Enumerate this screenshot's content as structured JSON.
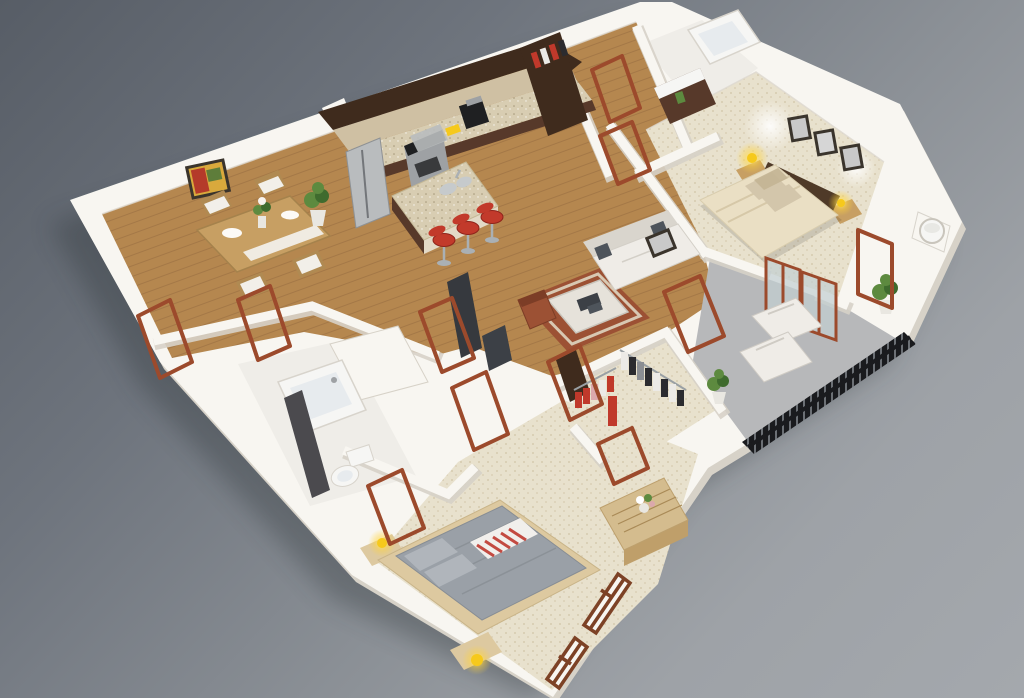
{
  "scene": {
    "type": "isometric-3d-apartment-floor-plan-render",
    "rooms": [
      {
        "name": "kitchen",
        "floor": "wood",
        "items": [
          "upper-cabinets",
          "lower-cabinets",
          "backsplash",
          "refrigerator",
          "range-oven",
          "range-hood",
          "coffee-maker",
          "kitchen-island",
          "island-sink",
          "bar-stools"
        ]
      },
      {
        "name": "dining-area",
        "floor": "wood",
        "items": [
          "dining-table",
          "table-runner",
          "plates",
          "flower-vase",
          "dining-chairs",
          "wall-art",
          "potted-plant"
        ]
      },
      {
        "name": "living-room",
        "floor": "wood",
        "items": [
          "sofa",
          "throw-pillows",
          "wall-picture",
          "area-rug",
          "coffee-table",
          "armchair",
          "tv-panel",
          "media-console"
        ]
      },
      {
        "name": "master-bedroom",
        "floor": "carpet",
        "items": [
          "double-bed",
          "headboard",
          "pillows",
          "nightstand",
          "table-lamp",
          "picture-frames",
          "balcony-doors"
        ]
      },
      {
        "name": "balcony",
        "floor": "concrete",
        "items": [
          "lounge-chairs",
          "potted-plant",
          "railing"
        ]
      },
      {
        "name": "walk-in-closet",
        "floor": "carpet",
        "items": [
          "clothes-rack",
          "hanging-clothes",
          "shelf-unit"
        ]
      },
      {
        "name": "guest-bedroom",
        "floor": "carpet",
        "items": [
          "bed",
          "gray-duvet",
          "striped-throw",
          "nightstands",
          "table-lamps",
          "dresser",
          "flower-vase",
          "windows",
          "door"
        ]
      },
      {
        "name": "bathroom",
        "floor": "tile",
        "items": [
          "bathtub",
          "toilet",
          "shower-partition",
          "laundry-closet"
        ]
      },
      {
        "name": "entry-hall",
        "floor": "wood",
        "items": [
          "entry-closet",
          "hanging-clothes",
          "doors"
        ]
      },
      {
        "name": "second-bathroom",
        "floor": "tile",
        "items": [
          "bathtub",
          "vanity",
          "towel"
        ]
      },
      {
        "name": "utility-closet",
        "floor": "wood",
        "items": [
          "water-heater"
        ]
      }
    ]
  },
  "palette": {
    "shadow": "#2c3036",
    "wall_top": "#f8f6f1",
    "wall_face": "#e9e4db",
    "wall_edge": "#d7d2c8",
    "wall_inner": "#ddd8cf",
    "wood": "#b5874f",
    "wood_line": "#9c7242",
    "carpet": "#e8e1cd",
    "carpet_dot": "#cbbc9c",
    "balcony_floor": "#b7b8ba",
    "tile": "#efede8",
    "cabinet_dark": "#3f2b1d",
    "cabinet_mid": "#57392a",
    "granite": "#d8cdb2",
    "granite_dot": "#8d815f",
    "backsplash": "#cfc0a3",
    "stainless": "#b9bcbe",
    "stainless_dark": "#9ea1a4",
    "appliance_black": "#1f2022",
    "island_base": "#e3d9c6",
    "stool_red": "#c23a2b",
    "stool_red_dark": "#8f241b",
    "metal": "#aab0b4",
    "dining_wood": "#c79f63",
    "chair_wood": "#b08a52",
    "cushion_white": "#f2efe9",
    "art_red": "#b43a2a",
    "art_green": "#5e7d3a",
    "art_gold": "#d9a93c",
    "frame_dark": "#3a342c",
    "plant": "#5d8a3f",
    "plant_dark": "#3f6b2e",
    "pot": "#e9e7e1",
    "sofa": "#efece7",
    "sofa_shadow": "#d9d5cd",
    "pillow_dark": "#4e545b",
    "rug": "#9c5134",
    "rug_light": "#d8c8b2",
    "table_light": "#e6e2da",
    "book_dark": "#3c4046",
    "tv_dark": "#36393e",
    "bed_cream": "#eadfc4",
    "bed_cream_shadow": "#d6c8a8",
    "pillow_beige": "#d3c6ab",
    "headboard": "#4f3a28",
    "lamp_yellow": "#f6c91c",
    "rail_dark": "#1a1b1e",
    "rail_gap": "#75797f",
    "closet_red": "#c0392b",
    "closet_white": "#eceae6",
    "closet_black": "#2b2b2f",
    "closet_pink": "#dba8ac",
    "closet_gray": "#8b8e93",
    "rod": "#9aa0a4",
    "dresser": "#d4bc8e",
    "dresser_face": "#bf9f6a",
    "bed_gray": "#9aa0a7",
    "bed_gray_light": "#b0b5bb",
    "bed_frame": "#ddc9a0",
    "blanket_red": "#c34a41",
    "blanket_white": "#f1efec",
    "door_brown": "#9c4a2c",
    "window_brown": "#7d4226",
    "tub_white": "#f6f6f4",
    "tub_inner": "#e7ebee",
    "partition": "#4b4a4e",
    "fixture": "#c6cacc",
    "glass": "#c2ced2"
  }
}
